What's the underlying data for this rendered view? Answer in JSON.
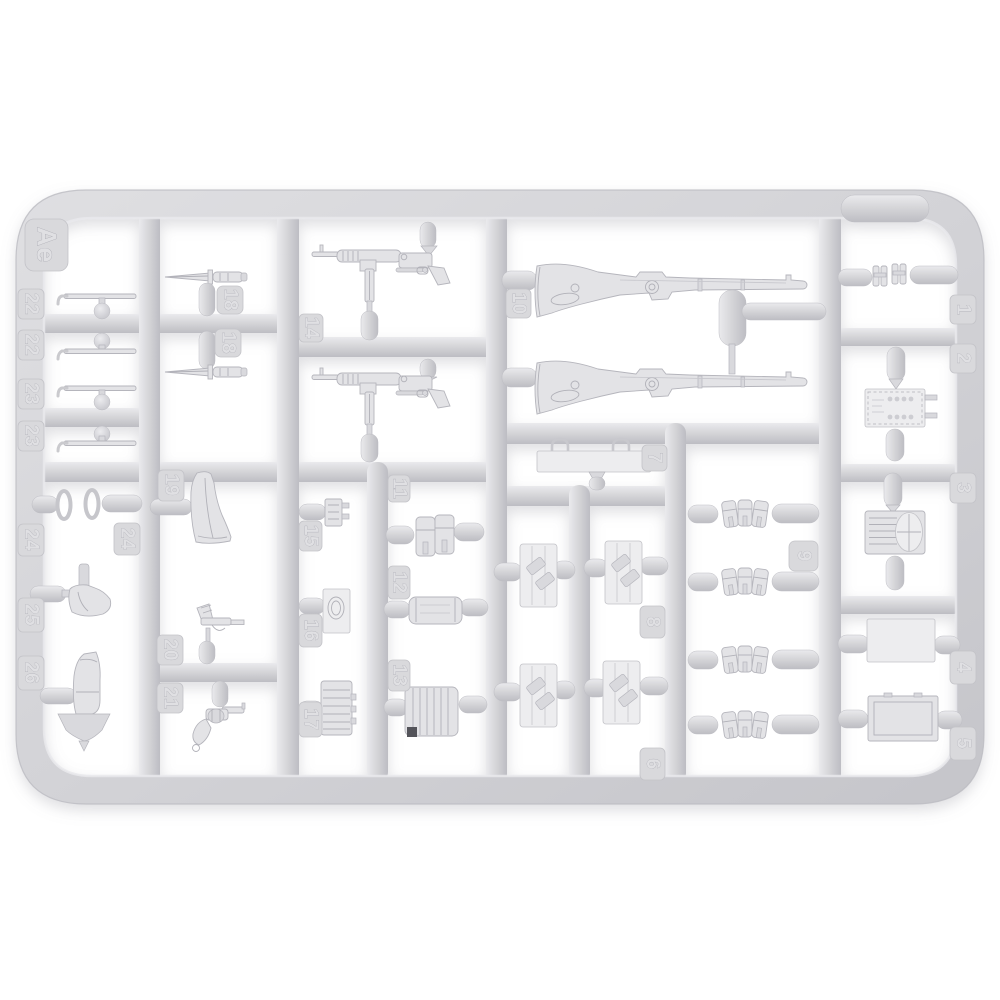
{
  "photo": {
    "subject": "injection-molded plastic model kit sprue",
    "background_color": "#ffffff",
    "plastic_color": "#d6d6d9",
    "plastic_highlight": "#e9e9ec",
    "plastic_shadow": "#bdbdc3"
  },
  "sprue": {
    "letter": "Ae",
    "parts": [
      {
        "number": "1",
        "shape": "binoculars-pair"
      },
      {
        "number": "2",
        "shape": "equipment-case"
      },
      {
        "number": "3",
        "shape": "ammo-drum-case"
      },
      {
        "number": "4",
        "shape": "flat-panel"
      },
      {
        "number": "5",
        "shape": "crate-lid"
      },
      {
        "number": "6",
        "shape": "panel-with-pouches"
      },
      {
        "number": "7",
        "shape": "plate-with-clamps"
      },
      {
        "number": "8",
        "shape": "panel-with-pouches"
      },
      {
        "number": "9",
        "shape": "triple-ammo-pouch",
        "quantity": 4
      },
      {
        "number": "10",
        "shape": "kar98k-rifle",
        "quantity": 2
      },
      {
        "number": "11",
        "shape": "double-pouch"
      },
      {
        "number": "12",
        "shape": "gas-mask-canister"
      },
      {
        "number": "13",
        "shape": "drum-magazine"
      },
      {
        "number": "14",
        "shape": "mp40-smg",
        "quantity": 2
      },
      {
        "number": "15",
        "shape": "small-bracket"
      },
      {
        "number": "16",
        "shape": "buckle-plate"
      },
      {
        "number": "17",
        "shape": "ribbed-pouch-stack"
      },
      {
        "number": "18",
        "shape": "bayonet",
        "quantity": 2
      },
      {
        "number": "19",
        "shape": "holster-body"
      },
      {
        "number": "20",
        "shape": "pistol"
      },
      {
        "number": "21",
        "shape": "revolver"
      },
      {
        "number": "22",
        "shape": "hooked-rod",
        "quantity": 2
      },
      {
        "number": "23",
        "shape": "hooked-rod",
        "quantity": 2
      },
      {
        "number": "24",
        "shape": "oval-ring",
        "quantity": 2
      },
      {
        "number": "25",
        "shape": "holster"
      },
      {
        "number": "26",
        "shape": "holster-with-spade"
      }
    ]
  },
  "tags": {
    "sprue_letter": "Ae",
    "n1": "1",
    "n2": "2",
    "n3": "3",
    "n4": "4",
    "n5": "5",
    "n6": "6",
    "n7": "7",
    "n8": "8",
    "n9": "9",
    "n10": "10",
    "n11": "11",
    "n12": "12",
    "n13": "13",
    "n14": "14",
    "n15": "15",
    "n16": "16",
    "n17": "17",
    "n18": "18",
    "n19": "19",
    "n20": "20",
    "n21": "21",
    "n22": "22",
    "n23": "23",
    "n24": "24",
    "n25": "25",
    "n26": "26"
  }
}
